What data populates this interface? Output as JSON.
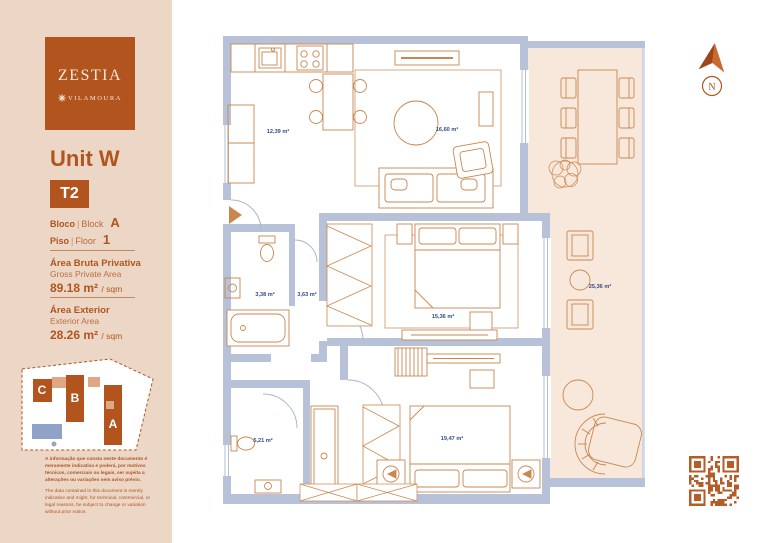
{
  "brand": {
    "name": "ZESTIA",
    "location": "VILAMOURA"
  },
  "unit": {
    "title": "Unit W",
    "typology": "T2",
    "block": {
      "label_pt": "Bloco",
      "label_en": "Block",
      "value": "A"
    },
    "floor": {
      "label_pt": "Piso",
      "label_en": "Floor",
      "value": "1"
    }
  },
  "areas": {
    "gross": {
      "title_pt": "Área Bruta Privativa",
      "title_en": "Gross Private Area",
      "value": "89.18 m²",
      "suffix": "/ sqm"
    },
    "exterior": {
      "title_pt": "Área Exterior",
      "title_en": "Exterior Area",
      "value": "28.26 m²",
      "suffix": "/ sqm"
    }
  },
  "site_map": {
    "blocks": [
      "C",
      "B",
      "A"
    ]
  },
  "disclaimer": {
    "pt": "A informação que consta neste documento é meramente indicativa e poderá, por motivos técnicos, comerciais ou legais, ser sujeita a alterações ou variações sem aviso prévio.",
    "en": "The data contained in this document is merely indicative and might, for technical, commercial, or legal reasons, be subject to change or variation without prior notice."
  },
  "plan": {
    "compass_letter": "N",
    "rooms": [
      {
        "name": "kitchen",
        "area": "12,39 m²"
      },
      {
        "name": "living-room",
        "area": "16,60 m²"
      },
      {
        "name": "bathroom-1",
        "area": "3,38 m²"
      },
      {
        "name": "hall",
        "area": "3,63 m²"
      },
      {
        "name": "bedroom-1",
        "area": "15,36 m²"
      },
      {
        "name": "bathroom-2",
        "area": "5,21 m²"
      },
      {
        "name": "bedroom-2",
        "area": "19,47 m²"
      },
      {
        "name": "terrace",
        "area": "25,36 m²"
      }
    ],
    "colors": {
      "accent": "#b1541e",
      "sidebar_bg": "#ecd7c6",
      "wall": "#b7c2d8",
      "furniture_line": "#c9874f",
      "terrace_fill": "#f8e8db",
      "label_text": "#2f4d87",
      "qr": "#b65c26"
    }
  }
}
